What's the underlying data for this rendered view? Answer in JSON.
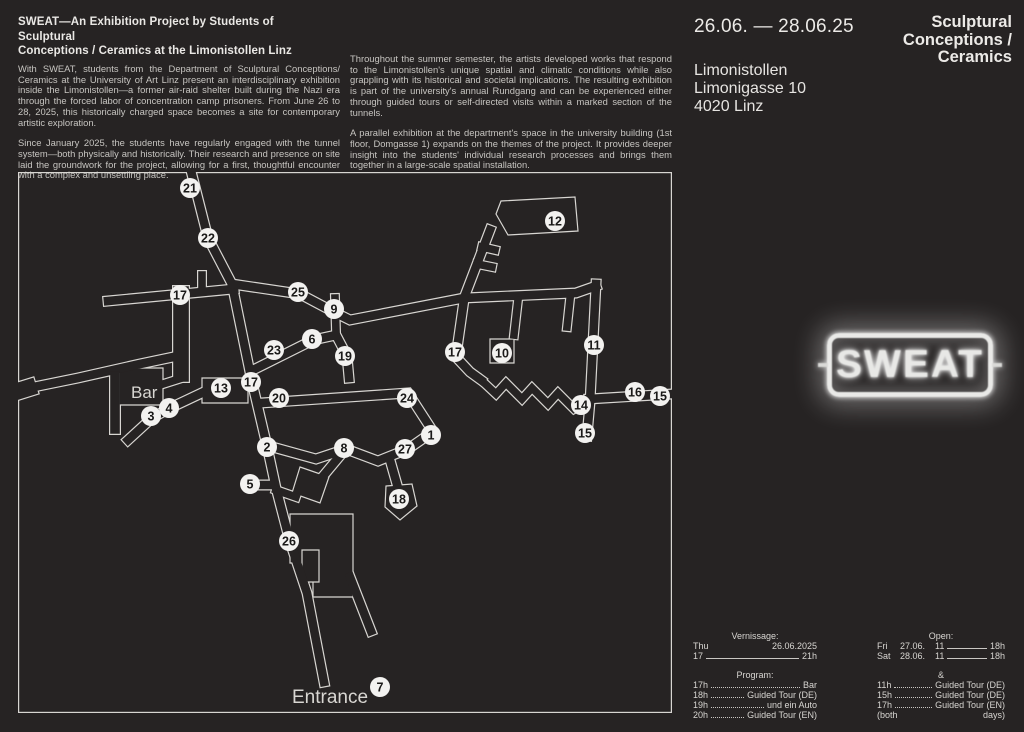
{
  "page": {
    "bg": "#262323",
    "heading_color": "#eceae7",
    "body_color": "#c7c5c1"
  },
  "header": {
    "title_lines": [
      "SWEAT—An Exhibition Project by Students of Sculptural",
      "Conceptions / Ceramics at the Limonistollen Linz"
    ]
  },
  "intro": {
    "paragraphs": [
      "With SWEAT, students from the Department of Sculptural Conceptions/ Ceramics at the University of Art Linz present an interdisciplinary exhibition inside the Limonistollen—a former air-raid shelter built during the Nazi era through the forced labor of concentration camp prisoners. From June 26 to 28, 2025, this historically charged space becomes a site for contemporary artistic exploration.",
      "Since January 2025, the students have regularly engaged with the tunnel system—both physically and historically. Their research and presence on site laid the groundwork for the project, allowing for a first, thoughtful encounter with a complex and unsettling place."
    ]
  },
  "details": {
    "paragraphs": [
      "Throughout the summer semester, the artists developed works that respond to the Limonistollen's unique spatial and climatic conditions while also grappling with its historical and societal implications. The resulting exhibition is part of the university's annual Rundgang and can be experienced either through guided tours or self-directed visits within a marked section of the tunnels.",
      "A parallel exhibition at the department's space in the university building (1st floor, Domgasse 1) expands on the themes of the project. It provides deeper insight into the students' individual research processes and brings them together in a large-scale spatial installation."
    ]
  },
  "event": {
    "dates": "26.06. — 28.06.25",
    "department": [
      "Sculptural",
      "Conceptions /",
      "Ceramics"
    ],
    "address": [
      "Limonistollen",
      "Limonigasse 10",
      "4020 Linz"
    ]
  },
  "sign": {
    "label": "SWEAT",
    "glow_color": "#ffffff"
  },
  "map": {
    "line_color": "#d8d6d2",
    "station_fill": "#f3f2f0",
    "station_text_color": "#1a1918",
    "labels": [
      {
        "text": "Bar",
        "x": 113,
        "y": 226,
        "size": 17
      },
      {
        "text": "Entrance",
        "x": 274,
        "y": 531,
        "size": 19
      }
    ],
    "stations": [
      {
        "n": "21",
        "x": 172,
        "y": 16
      },
      {
        "n": "22",
        "x": 190,
        "y": 66
      },
      {
        "n": "17",
        "x": 162,
        "y": 123
      },
      {
        "n": "25",
        "x": 280,
        "y": 120
      },
      {
        "n": "9",
        "x": 316,
        "y": 137
      },
      {
        "n": "23",
        "x": 256,
        "y": 178
      },
      {
        "n": "6",
        "x": 294,
        "y": 167
      },
      {
        "n": "19",
        "x": 327,
        "y": 184
      },
      {
        "n": "13",
        "x": 203,
        "y": 216
      },
      {
        "n": "17",
        "x": 233,
        "y": 210
      },
      {
        "n": "20",
        "x": 261,
        "y": 226
      },
      {
        "n": "24",
        "x": 389,
        "y": 226
      },
      {
        "n": "17",
        "x": 437,
        "y": 180
      },
      {
        "n": "10",
        "x": 484,
        "y": 181
      },
      {
        "n": "12",
        "x": 537,
        "y": 49
      },
      {
        "n": "11",
        "x": 576,
        "y": 173
      },
      {
        "n": "16",
        "x": 617,
        "y": 220
      },
      {
        "n": "15",
        "x": 642,
        "y": 224
      },
      {
        "n": "14",
        "x": 563,
        "y": 233
      },
      {
        "n": "15",
        "x": 567,
        "y": 261
      },
      {
        "n": "3",
        "x": 133,
        "y": 244
      },
      {
        "n": "4",
        "x": 151,
        "y": 236
      },
      {
        "n": "2",
        "x": 249,
        "y": 275
      },
      {
        "n": "8",
        "x": 326,
        "y": 276
      },
      {
        "n": "27",
        "x": 387,
        "y": 277
      },
      {
        "n": "1",
        "x": 413,
        "y": 263
      },
      {
        "n": "5",
        "x": 232,
        "y": 312
      },
      {
        "n": "18",
        "x": 381,
        "y": 327
      },
      {
        "n": "26",
        "x": 271,
        "y": 369
      },
      {
        "n": "7",
        "x": 362,
        "y": 515
      }
    ],
    "corridors": [
      {
        "name": "main-spine",
        "pts": [
          [
            172,
            -5
          ],
          [
            190,
            66
          ],
          [
            214,
            112
          ],
          [
            234,
            210
          ],
          [
            249,
            274
          ],
          [
            258,
            316
          ],
          [
            272,
            370
          ],
          [
            289,
            421
          ],
          [
            306,
            510
          ]
        ]
      },
      {
        "name": "gallery-17-west",
        "pts": [
          [
            90,
            129
          ],
          [
            216,
            117
          ]
        ]
      },
      {
        "name": "stub-17-north",
        "w": 10,
        "pts": [
          [
            184,
            103
          ],
          [
            184,
            118
          ]
        ]
      },
      {
        "name": "west-funnel",
        "pts": [
          [
            -4,
            219
          ],
          [
            60,
            206
          ],
          [
            122,
            192
          ],
          [
            160,
            184
          ]
        ]
      },
      {
        "name": "west-funnel-flare",
        "w": 19,
        "pts": [
          [
            -6,
            221
          ],
          [
            10,
            216
          ]
        ]
      },
      {
        "name": "bar-room-link",
        "w": 10,
        "pts": [
          [
            142,
            213
          ],
          [
            164,
            206
          ]
        ]
      },
      {
        "name": "bar-connector",
        "w": 18,
        "pts": [
          [
            163,
            122
          ],
          [
            163,
            202
          ]
        ]
      },
      {
        "name": "corridor-3-4",
        "pts": [
          [
            110,
            268
          ],
          [
            134,
            246
          ],
          [
            152,
            236
          ],
          [
            188,
            219
          ]
        ]
      },
      {
        "name": "west-deadend",
        "w": 12,
        "pts": [
          [
            97,
            204
          ],
          [
            97,
            257
          ]
        ]
      },
      {
        "name": "corridor-25-9",
        "pts": [
          [
            214,
            112
          ],
          [
            282,
            122
          ],
          [
            316,
            140
          ],
          [
            332,
            148
          ],
          [
            446,
            126
          ],
          [
            558,
            121
          ],
          [
            578,
            114
          ]
        ]
      },
      {
        "name": "stub-9",
        "w": 10,
        "pts": [
          [
            317,
            126
          ],
          [
            318,
            160
          ]
        ]
      },
      {
        "name": "corridor-23-6-19",
        "pts": [
          [
            237,
            197
          ],
          [
            295,
            168
          ],
          [
            318,
            163
          ],
          [
            329,
            184
          ],
          [
            331,
            206
          ]
        ]
      },
      {
        "name": "corridor-20-24",
        "pts": [
          [
            243,
            231
          ],
          [
            390,
            221
          ],
          [
            414,
            258
          ]
        ]
      },
      {
        "name": "corridor-2-8-27-1",
        "pts": [
          [
            251,
            274
          ],
          [
            298,
            287
          ],
          [
            328,
            277
          ],
          [
            360,
            289
          ],
          [
            390,
            277
          ],
          [
            413,
            261
          ]
        ]
      },
      {
        "name": "stub-18",
        "pts": [
          [
            372,
            288
          ],
          [
            380,
            316
          ]
        ]
      },
      {
        "name": "stub-8-room",
        "pts": [
          [
            326,
            279
          ],
          [
            301,
            309
          ]
        ]
      },
      {
        "name": "stub-5",
        "pts": [
          [
            230,
            313
          ],
          [
            252,
            313
          ]
        ]
      },
      {
        "name": "stub-east-2",
        "w": 10,
        "pts": [
          [
            258,
            318
          ],
          [
            278,
            325
          ]
        ]
      },
      {
        "name": "corridor-12-approach",
        "pts": [
          [
            446,
            126
          ],
          [
            472,
            58
          ]
        ]
      },
      {
        "name": "teeth-12-a",
        "w": 10,
        "pts": [
          [
            459,
            92
          ],
          [
            474,
            95
          ]
        ]
      },
      {
        "name": "teeth-12-b",
        "w": 10,
        "pts": [
          [
            464,
            75
          ],
          [
            477,
            78
          ]
        ]
      },
      {
        "name": "stub-10",
        "w": 10,
        "pts": [
          [
            500,
            128
          ],
          [
            496,
            163
          ]
        ]
      },
      {
        "name": "stub-mid-east",
        "w": 10,
        "pts": [
          [
            552,
            127
          ],
          [
            549,
            155
          ]
        ]
      },
      {
        "name": "corridor-17c",
        "pts": [
          [
            446,
            128
          ],
          [
            440,
            170
          ],
          [
            438,
            185
          ],
          [
            452,
            200
          ],
          [
            463,
            208
          ]
        ]
      },
      {
        "name": "sawtooth",
        "w": 10,
        "pts": [
          [
            463,
            208
          ],
          [
            478,
            222
          ],
          [
            488,
            211
          ],
          [
            504,
            227
          ],
          [
            514,
            216
          ],
          [
            530,
            232
          ],
          [
            540,
            221
          ],
          [
            556,
            237
          ],
          [
            566,
            231
          ]
        ]
      },
      {
        "name": "corridor-11",
        "pts": [
          [
            578,
            112
          ],
          [
            572,
            230
          ],
          [
            569,
            264
          ]
        ]
      },
      {
        "name": "arm-16",
        "pts": [
          [
            571,
            227
          ],
          [
            654,
            222
          ]
        ]
      },
      {
        "name": "stub-complex",
        "pts": [
          [
            332,
            405
          ],
          [
            353,
            459
          ]
        ]
      }
    ],
    "rooms": [
      {
        "name": "bar-room",
        "pts": [
          [
            101,
            196
          ],
          [
            145,
            196
          ],
          [
            145,
            233
          ],
          [
            101,
            233
          ]
        ]
      },
      {
        "name": "room-13",
        "pts": [
          [
            184,
            206
          ],
          [
            230,
            206
          ],
          [
            230,
            231
          ],
          [
            184,
            231
          ]
        ]
      },
      {
        "name": "room-10",
        "pts": [
          [
            472,
            167
          ],
          [
            496,
            167
          ],
          [
            496,
            191
          ],
          [
            472,
            191
          ]
        ]
      },
      {
        "name": "room-12",
        "pts": [
          [
            478,
            42
          ],
          [
            483,
            29
          ],
          [
            557,
            25
          ],
          [
            560,
            59
          ],
          [
            490,
            63
          ]
        ]
      },
      {
        "name": "room-18",
        "pts": [
          [
            368,
            314
          ],
          [
            394,
            312
          ],
          [
            399,
            334
          ],
          [
            382,
            348
          ],
          [
            367,
            335
          ]
        ]
      },
      {
        "name": "room-26-complex",
        "pts": [
          [
            272,
            342
          ],
          [
            335,
            342
          ],
          [
            335,
            425
          ],
          [
            295,
            425
          ],
          [
            295,
            391
          ],
          [
            272,
            391
          ]
        ]
      },
      {
        "name": "room-26-inner",
        "pts": [
          [
            284,
            378
          ],
          [
            301,
            378
          ],
          [
            301,
            410
          ],
          [
            284,
            410
          ]
        ]
      },
      {
        "name": "room-8-end",
        "pts": [
          [
            282,
            295
          ],
          [
            311,
            305
          ],
          [
            302,
            331
          ],
          [
            274,
            321
          ]
        ]
      }
    ]
  },
  "schedule": {
    "vernissage": {
      "heading": "Vernissage:",
      "day": "Thu",
      "date": "26.06.2025",
      "from": "17",
      "to": "21h"
    },
    "program": {
      "heading": "Program:",
      "rows": [
        {
          "time": "17h",
          "label": "Bar"
        },
        {
          "time": "18h",
          "label": "Guided Tour (DE)"
        },
        {
          "time": "19h",
          "label": "und ein Auto"
        },
        {
          "time": "20h",
          "label": "Guided Tour (EN)"
        }
      ]
    },
    "open": {
      "heading": "Open:",
      "rows": [
        {
          "day": "Fri",
          "date": "27.06.",
          "from": "11",
          "to": "18h"
        },
        {
          "day": "Sat",
          "date": "28.06.",
          "from": "11",
          "to": "18h"
        }
      ]
    },
    "tours": {
      "heading": "&",
      "rows": [
        {
          "time": "11h",
          "label": "Guided Tour (DE)"
        },
        {
          "time": "15h",
          "label": "Guided Tour (DE)"
        },
        {
          "time": "17h",
          "label": "Guided Tour (EN)"
        }
      ],
      "note_left": "(both",
      "note_right": "days)"
    }
  }
}
